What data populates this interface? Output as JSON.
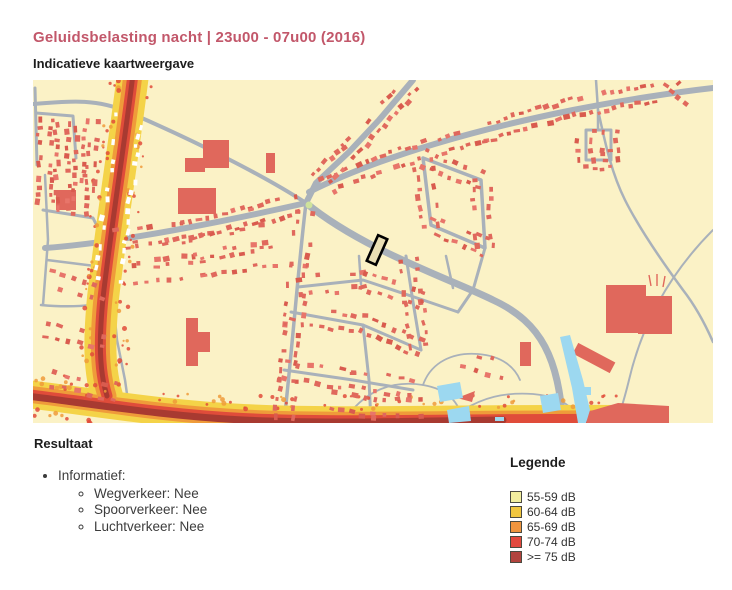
{
  "page": {
    "title": "Geluidsbelasting nacht | 23u00 - 07u00 (2016)",
    "subtitle": "Indicatieve kaartweergave"
  },
  "theme": {
    "title_color": "#c2576a"
  },
  "map": {
    "name": "Indicatieve geluidskaart nacht",
    "colors": {
      "map-bg": "#fbf2c6",
      "map-road": "#a9b1ba",
      "map-building": "#e0685c",
      "map-building-alt": "#d95b4e",
      "map-building-light": "#e8756a",
      "map-white-building": "#ffffff",
      "map-water": "#9cd8f0",
      "map-green": "#cfe39b",
      "map-noise-yellow": "#f4d348",
      "map-noise-orange": "#ef9b3a",
      "map-noise-red": "#e04c3a",
      "map-noise-dark": "#a83a31",
      "map-selection": "#000000",
      "map-selection-fill": "#e9dfb4"
    }
  },
  "result": {
    "heading": "Resultaat",
    "items": [
      {
        "label": "Informatief:",
        "children": [
          {
            "label": "Wegverkeer: Nee"
          },
          {
            "label": "Spoorverkeer: Nee"
          },
          {
            "label": "Luchtverkeer: Nee"
          }
        ]
      }
    ]
  },
  "legend": {
    "heading": "Legende",
    "swatch_border": "#4a4a40",
    "entries": [
      {
        "label": "55-59 dB",
        "color": "#f2ee9e"
      },
      {
        "label": "60-64 dB",
        "color": "#f0c63f"
      },
      {
        "label": "65-69 dB",
        "color": "#ef953f"
      },
      {
        "label": "70-74 dB",
        "color": "#e2493e"
      },
      {
        "label": ">= 75 dB",
        "color": "#b2443e"
      }
    ]
  }
}
